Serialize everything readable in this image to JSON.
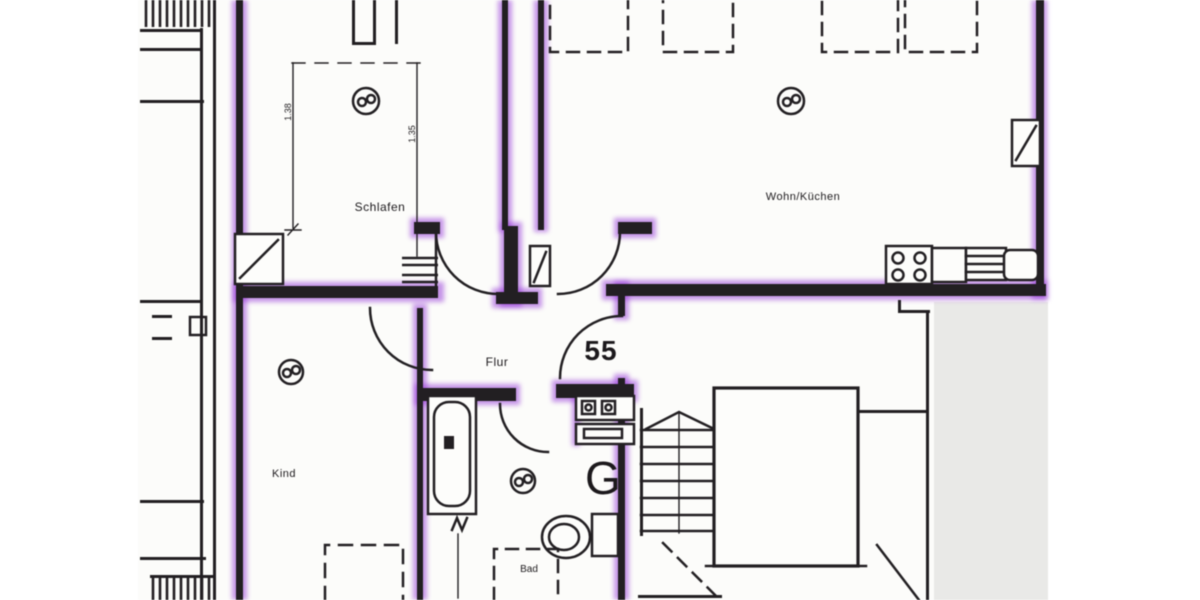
{
  "document": {
    "kind": "scanned apartment floor plan",
    "apartment_number": "55"
  },
  "labels": {
    "schlafen": "Schlafen",
    "wohnkueche": "Wohn/Küchen",
    "flur": "Flur",
    "kind": "Kind",
    "bad": "Bad",
    "apartment_number": "55",
    "boiler_symbol": "G",
    "dim_left": "1.38",
    "dim_right": "1.35"
  },
  "colors": {
    "highlight_purple": "#9333d6",
    "line_black": "#221f22",
    "paper": "#fcfcfa",
    "blank_gray": "#e9e9e7"
  },
  "symbols": [
    "room-symbol-circle-schlafen",
    "room-symbol-circle-wohnkueche",
    "room-symbol-circle-kind",
    "room-symbol-circle-bad",
    "chimney-flue-box-schlafen",
    "chimney-flue-box-wohnkueche",
    "stove-4-burner",
    "kitchen-sink",
    "bathtub",
    "washbasin-unit",
    "toilet",
    "stairs",
    "elevator-shaft",
    "entrance-door-swing",
    "balcony-hatching"
  ]
}
